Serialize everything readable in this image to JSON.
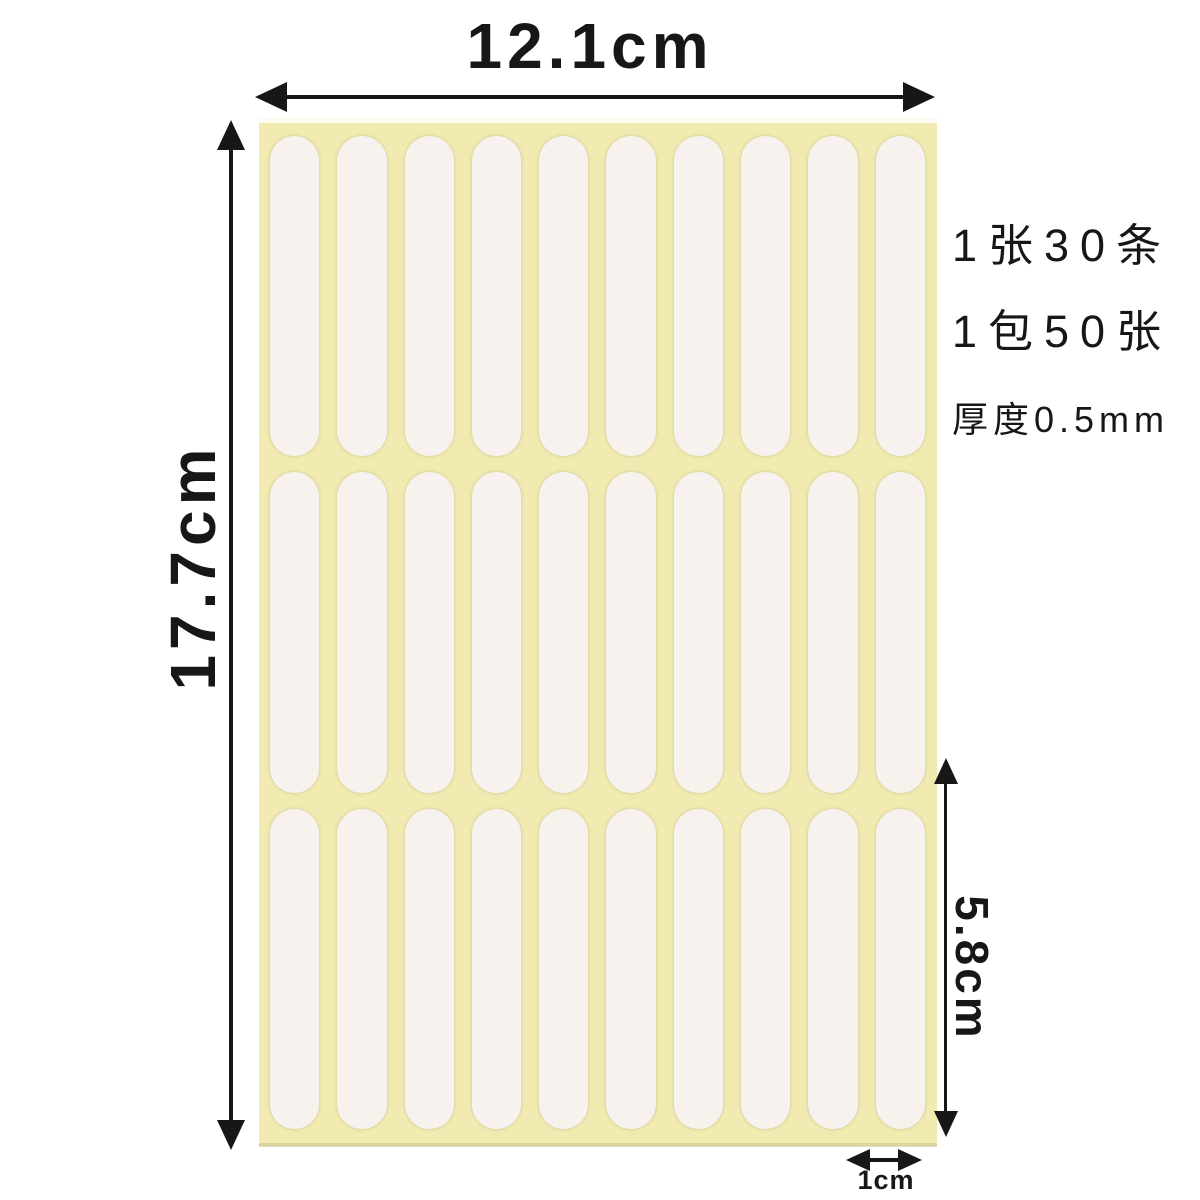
{
  "image": {
    "description": "double-sided adhesive strip sheet with dimension annotations",
    "background_color": "#ffffff",
    "annotation_color": "#171717"
  },
  "dimensions": {
    "sheet_width_label": "12.1cm",
    "sheet_height_label": "17.7cm",
    "strip_length_label": "5.8cm",
    "strip_width_label": "1cm"
  },
  "specs": {
    "line1": "1张30条",
    "line2": "1包50张",
    "line3": "厚度0.5mm"
  },
  "sheet": {
    "rows": 3,
    "columns": 10,
    "base_color": "#f1ebb2",
    "top_edge_color": "#fbf9f0",
    "strip_color": "#f7f2ee"
  }
}
